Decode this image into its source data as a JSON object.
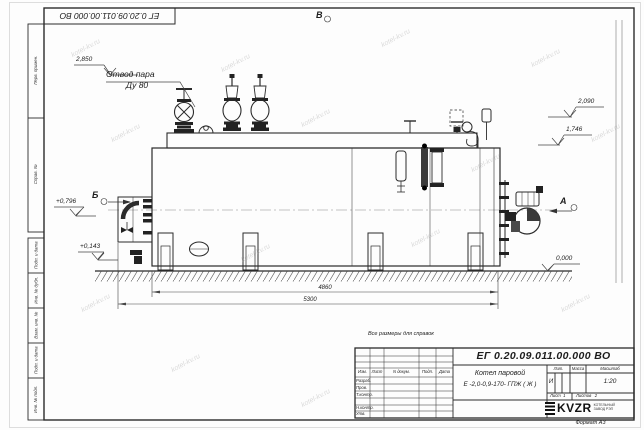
{
  "sheet": {
    "doc_number": "ЕГ 0.20.09.011.00.000  ВО",
    "format_label": "Формат А3",
    "reference_note": "Все размеры для справок",
    "watermark": "kotel-kv.ru"
  },
  "left_columns": {
    "perv_primen": "Перв. примен.",
    "sprav_no": "Справ. №",
    "podp_data_1": "Подп. и дата",
    "inv_dubl": "Инв. № дубл.",
    "vzam_inv": "Взам. инв. №",
    "podp_data_2": "Подп. и дата",
    "inv_podl": "Инв. № подл."
  },
  "title_block": {
    "doc_number": "ЕГ 0.20.09.011.00.000  ВО",
    "product_name_line1": "Котел паровой",
    "product_name_line2": "Е -2,0-0,9-170- ГПЖ ( Ж )",
    "columns": {
      "izm": "Изм.",
      "list": "Лист",
      "n_dokum": "N докум.",
      "podp": "Подп.",
      "data": "Дата"
    },
    "rows": [
      "Разраб.",
      "Пров.",
      "Т.контр.",
      "Н.контр.",
      "Утв."
    ],
    "lit_label": "Лит.",
    "massa_label": "Масса",
    "masshtab_label": "Масштаб",
    "lit_value": "И",
    "masshtab_value": "1:20",
    "list_label": "Лист",
    "list_value": "1",
    "listov_label": "Листов",
    "listov_value": "2",
    "logo_text": "KVZR",
    "logo_sub1": "КОТЕЛЬНЫЙ",
    "logo_sub2": "ЗАВОД РЭП"
  },
  "annotations": {
    "steam_outlet_line1": "Отвод пара",
    "steam_outlet_line2": "Ду 80",
    "elev_2850": "2,850",
    "elev_2090": "2,090",
    "elev_1746": "1,746",
    "elev_0796": "+0,796",
    "elev_0143": "+0,143",
    "elev_0000": "0,000",
    "dim_4860": "4860",
    "dim_5300": "5300",
    "view_a": "А",
    "view_b": "Б",
    "view_v": "В"
  }
}
